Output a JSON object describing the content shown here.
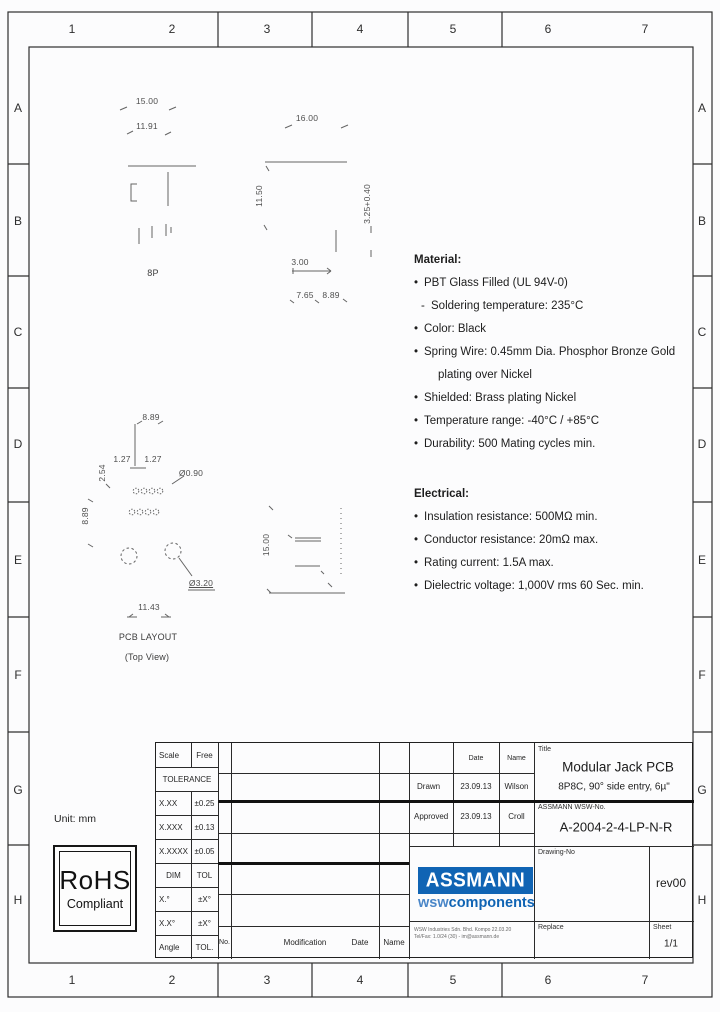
{
  "grid": {
    "cols": [
      "1",
      "2",
      "3",
      "4",
      "5",
      "6",
      "7"
    ],
    "rows": [
      "A",
      "B",
      "C",
      "D",
      "E",
      "F",
      "G",
      "H"
    ]
  },
  "unit_label": "Unit: mm",
  "views": {
    "front": {
      "dim_width": "15.00",
      "dim_opening": "11.91",
      "label": "8P"
    },
    "side_entry": {
      "dim_length": "16.00",
      "dim_height": "11.50",
      "dim_pin": "3.25+0.40",
      "dim_pitch": "3.00",
      "dim_a": "7.65",
      "dim_b": "8.89"
    },
    "pcb": {
      "dim_top": "8.89",
      "dim_p1": "1.27",
      "dim_p2": "1.27",
      "dim_row": "2.54",
      "dim_left": "8.89",
      "dia_pad": "Ø0.90",
      "dia_hole": "Ø3.20",
      "dim_span": "11.43",
      "title": "PCB LAYOUT",
      "subtitle": "(Top View)"
    },
    "side": {
      "dim_height": "15.00"
    }
  },
  "material": {
    "heading": "Material:",
    "items": [
      {
        "m": "•",
        "t": "PBT Glass Filled (UL 94V-0)"
      },
      {
        "m": "-",
        "t": "Soldering temperature: 235°C"
      },
      {
        "m": "•",
        "t": "Color: Black"
      },
      {
        "m": "•",
        "t": "Spring Wire: 0.45mm Dia. Phosphor Bronze Gold"
      },
      {
        "m": "",
        "t": "plating over Nickel"
      },
      {
        "m": "•",
        "t": "Shielded: Brass plating Nickel"
      },
      {
        "m": "•",
        "t": "Temperature range: -40°C / +85°C"
      },
      {
        "m": "•",
        "t": "Durability: 500 Mating cycles min."
      }
    ]
  },
  "electrical": {
    "heading": "Electrical:",
    "items": [
      {
        "m": "•",
        "t": "Insulation resistance: 500MΩ min."
      },
      {
        "m": "•",
        "t": "Conductor resistance: 20mΩ max."
      },
      {
        "m": "•",
        "t": "Rating current: 1.5A max."
      },
      {
        "m": "•",
        "t": "Dielectric voltage: 1,000V rms 60 Sec. min."
      }
    ]
  },
  "rohs": {
    "line1": "RoHS",
    "line2": "Compliant"
  },
  "title_block": {
    "scale_label": "Scale",
    "scale_value": "Free",
    "tolerance_label": "TOLERANCE",
    "tol_rows": [
      {
        "dim": "X.XX",
        "tol": "±0.25"
      },
      {
        "dim": "X.XXX",
        "tol": "±0.13"
      },
      {
        "dim": "X.XXXX",
        "tol": "±0.05"
      }
    ],
    "dim_label": "DIM",
    "tol_label": "TOL",
    "angle_rows": [
      {
        "dim": "X.°",
        "tol": "±X°"
      },
      {
        "dim": "X.X°",
        "tol": "±X°"
      }
    ],
    "angle_label": "Angle",
    "angle_tol": "TOL.",
    "rev_header": {
      "no": "No.",
      "modification": "Modification",
      "date": "Date",
      "name": "Name"
    },
    "approval": {
      "date_header": "Date",
      "name_header": "Name",
      "drawn_label": "Drawn",
      "drawn_date": "23.09.13",
      "drawn_name": "Wilson",
      "approved_label": "Approved",
      "approved_date": "23.09.13",
      "approved_name": "Croll"
    },
    "title_label": "Title",
    "title": "Modular Jack PCB",
    "subtitle": "8P8C, 90° side entry, 6µ\"",
    "wsw_no_label": "ASSMANN WSW-No.",
    "wsw_no": "A-2004-2-4-LP-N-R",
    "drawing_no_label": "Drawing-No",
    "revision": "rev00",
    "replace_label": "Replace",
    "sheet_label": "Sheet",
    "sheet_value": "1/1",
    "logo": {
      "line1": "ASSMANN",
      "line2_a": "wsw",
      "line2_b": "components",
      "blue": "#1064b4",
      "blue_light": "#4a86c8"
    },
    "address_line1": "WSW Industries Sdn. Bhd. Kompo 22.03.20",
    "address_line2": "Tel/Fax: 1.0/24 (30) - im@assmann.de"
  }
}
